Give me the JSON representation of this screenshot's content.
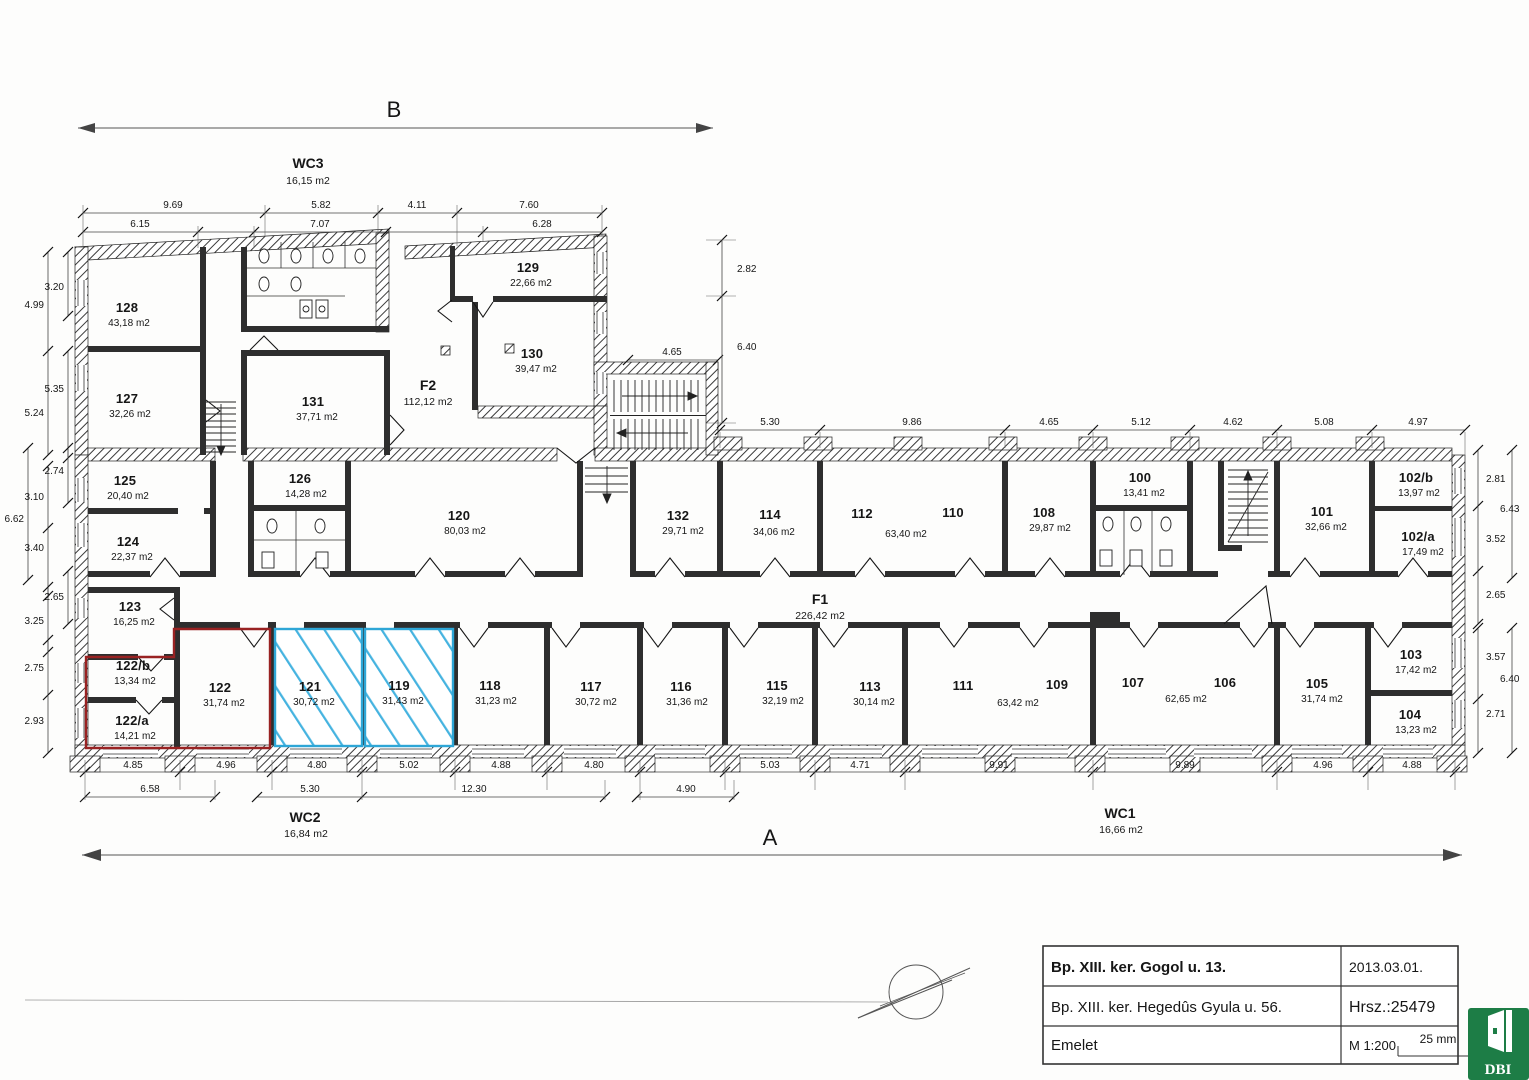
{
  "plan": {
    "axes": {
      "a": "A",
      "b": "B"
    },
    "halls": {
      "wc3": {
        "name": "WC3",
        "area": "16,15 m2"
      },
      "wc2": {
        "name": "WC2",
        "area": "16,84 m2"
      },
      "wc1": {
        "name": "WC1",
        "area": "16,66 m2"
      },
      "f1": {
        "name": "F1",
        "area": "226,42 m2"
      },
      "f2": {
        "name": "F2",
        "area": "112,12 m2"
      }
    },
    "rooms": {
      "r128": {
        "no": "128",
        "area": "43,18 m2"
      },
      "r127": {
        "no": "127",
        "area": "32,26 m2"
      },
      "r131": {
        "no": "131",
        "area": "37,71 m2"
      },
      "r129": {
        "no": "129",
        "area": "22,66 m2"
      },
      "r130": {
        "no": "130",
        "area": "39,47 m2"
      },
      "r125": {
        "no": "125",
        "area": "20,40 m2"
      },
      "r124": {
        "no": "124",
        "area": "22,37 m2"
      },
      "r126": {
        "no": "126",
        "area": "14,28 m2"
      },
      "r120": {
        "no": "120",
        "area": "80,03 m2"
      },
      "r132": {
        "no": "132",
        "area": "29,71 m2"
      },
      "r114": {
        "no": "114",
        "area": "34,06 m2"
      },
      "r112": {
        "no": "112"
      },
      "r110": {
        "no": "110"
      },
      "r108": {
        "no": "108",
        "area": "29,87 m2"
      },
      "r100": {
        "no": "100",
        "area": "13,41 m2"
      },
      "r101": {
        "no": "101",
        "area": "32,66 m2"
      },
      "r102b": {
        "no": "102/b",
        "area": "13,97 m2"
      },
      "r102a": {
        "no": "102/a",
        "area": "17,49 m2"
      },
      "r123": {
        "no": "123",
        "area": "16,25 m2"
      },
      "r122b": {
        "no": "122/b",
        "area": "13,34 m2"
      },
      "r122a": {
        "no": "122/a",
        "area": "14,21 m2"
      },
      "r122": {
        "no": "122",
        "area": "31,74 m2"
      },
      "r121": {
        "no": "121",
        "area": "30,72 m2"
      },
      "r119": {
        "no": "119",
        "area": "31,43 m2"
      },
      "r118": {
        "no": "118",
        "area": "31,23 m2"
      },
      "r117": {
        "no": "117",
        "area": "30,72 m2"
      },
      "r116": {
        "no": "116",
        "area": "31,36 m2"
      },
      "r115": {
        "no": "115",
        "area": "32,19 m2"
      },
      "r113": {
        "no": "113",
        "area": "30,14 m2"
      },
      "r111": {
        "no": "111"
      },
      "r109": {
        "no": "109"
      },
      "r107": {
        "no": "107"
      },
      "r106": {
        "no": "106"
      },
      "r105": {
        "no": "105",
        "area": "31,74 m2"
      },
      "r103": {
        "no": "103",
        "area": "17,42 m2"
      },
      "r104": {
        "no": "104",
        "area": "13,23 m2"
      }
    },
    "shared": {
      "s112_110": "63,40 m2",
      "s111_109": "63,42 m2",
      "s107_106": "62,65 m2"
    },
    "dims": {
      "top1": [
        "9.69",
        "5.82",
        "4.11",
        "7.60"
      ],
      "top2": [
        "6.15",
        "7.07",
        "6.28"
      ],
      "stair": "4.65",
      "right_upper": [
        "2.82",
        "6.40"
      ],
      "corridor_top": [
        "5.30",
        "9.86",
        "4.65",
        "5.12",
        "4.62",
        "5.08",
        "4.97"
      ],
      "left": [
        "3.20",
        "4.99",
        "5.35",
        "5.24",
        "2.74",
        "3.10",
        "6.62",
        "3.40",
        "2.65",
        "3.25",
        "2.75",
        "2.93"
      ],
      "right": [
        "2.81",
        "6.43",
        "3.52",
        "2.65",
        "3.57",
        "6.40",
        "2.71"
      ],
      "bottom1": [
        "4.85",
        "4.96",
        "4.80",
        "5.02",
        "4.88",
        "4.80",
        "5.03",
        "4.71",
        "9.91",
        "9.89",
        "4.96",
        "4.88"
      ],
      "bottom2": [
        "6.58",
        "5.30",
        "12.30",
        "4.90"
      ]
    }
  },
  "title_block": {
    "row1_left": "Bp. XIII. ker. Gogol u. 13.",
    "row1_right": "2013.03.01.",
    "row2_left": "Bp. XIII. ker. Hegedûs Gyula u. 56.",
    "row2_right": "Hrsz.:25479",
    "row3_left": "Emelet",
    "row3_right": "M 1:200",
    "scale_bar": "25 mm",
    "logo_text": "DBI"
  },
  "colors": {
    "highlight_red": "#992222",
    "highlight_blue": "#2ea6d6",
    "logo_green": "#1d7d46"
  }
}
